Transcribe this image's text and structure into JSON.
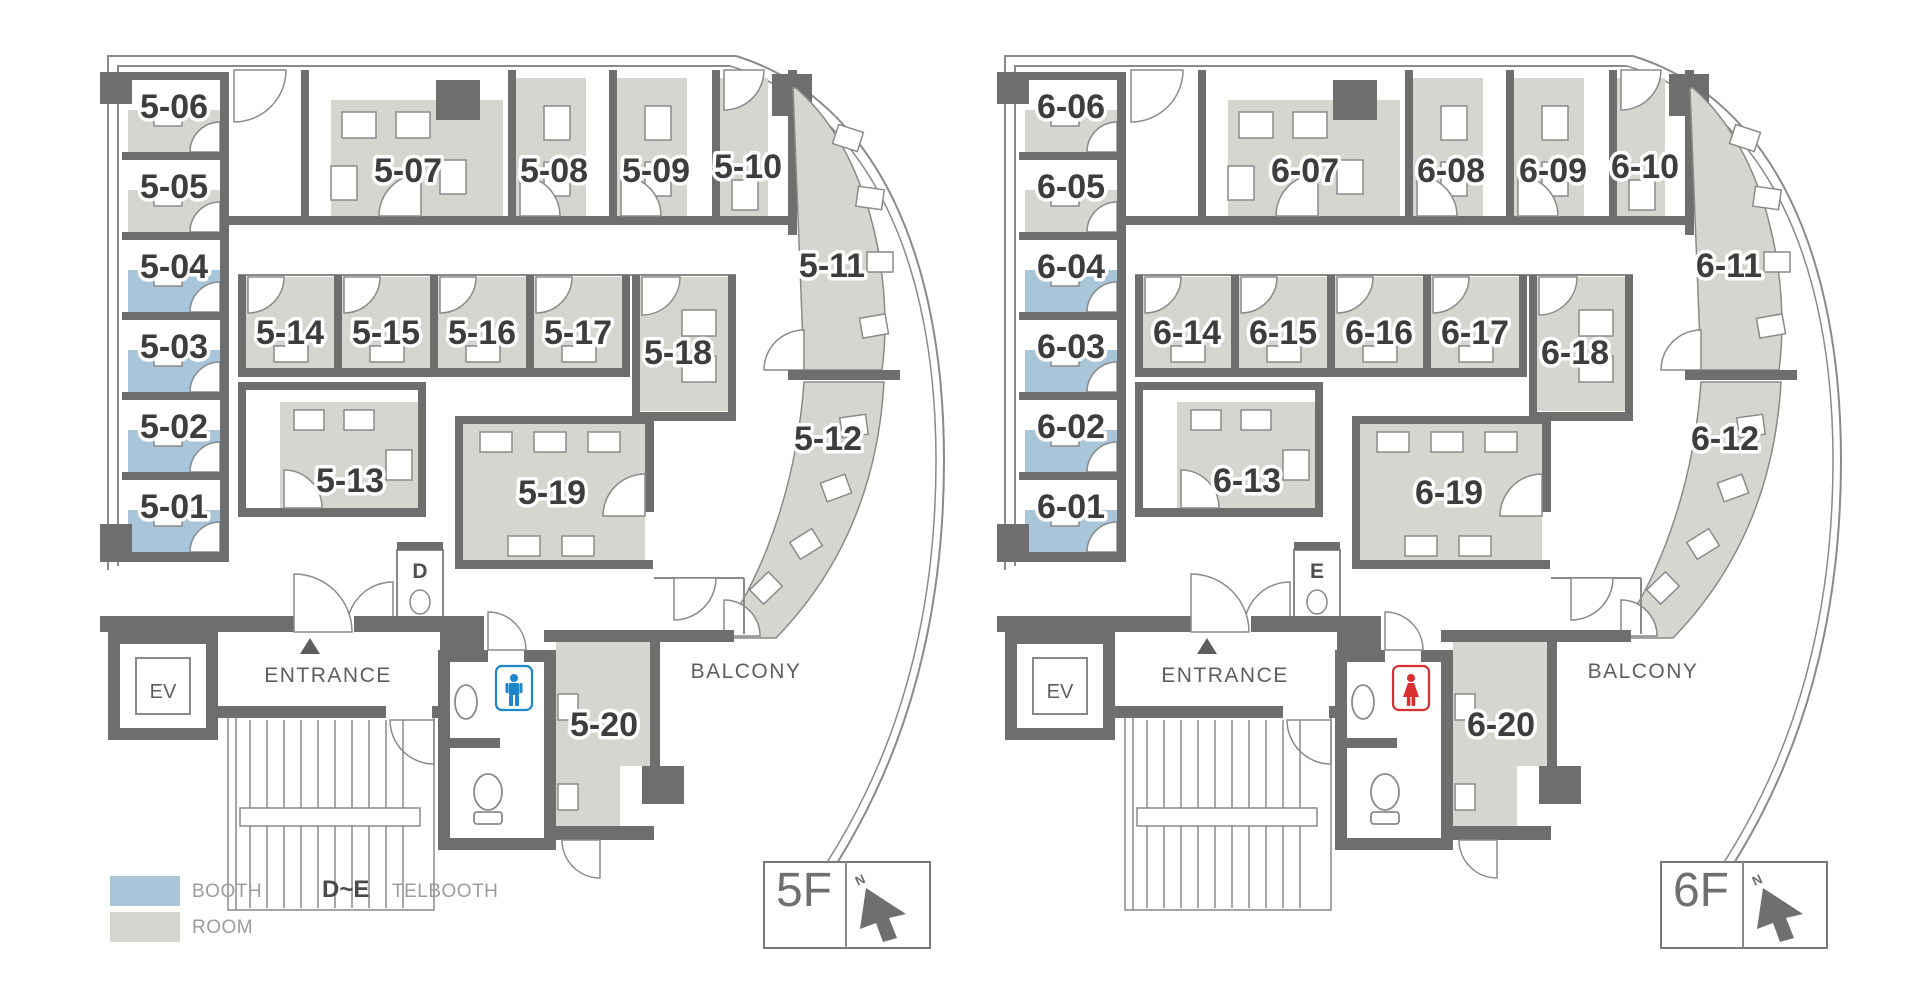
{
  "legend": {
    "booth_label": "BOOTH",
    "room_label": "ROOM",
    "telbooth_range": "D~E",
    "telbooth_label": "TELBOOTH"
  },
  "colors": {
    "booth": "#a9c5d9",
    "room": "#d6d6d1",
    "wall": "#6e6e6e",
    "line": "#8a8a8a",
    "label": "#3d3d3d",
    "text_muted": "#5e5e5e",
    "legend_text": "#9c9c9c",
    "male_icon": "#1d86c8",
    "female_icon": "#d92f2f",
    "marker_text": "#6f6f6f"
  },
  "floors": [
    {
      "name": "5F",
      "marker": {
        "floor": "5F",
        "north": "N"
      },
      "telbooth_letter": "D",
      "toilet_icon": "male",
      "labels": {
        "entrance": "ENTRANCE",
        "elevator": "EV",
        "balcony": "BALCONY"
      },
      "rooms": [
        {
          "id": "5-01",
          "type": "booth"
        },
        {
          "id": "5-02",
          "type": "booth"
        },
        {
          "id": "5-03",
          "type": "booth"
        },
        {
          "id": "5-04",
          "type": "booth"
        },
        {
          "id": "5-05",
          "type": "room"
        },
        {
          "id": "5-06",
          "type": "room"
        },
        {
          "id": "5-07",
          "type": "room"
        },
        {
          "id": "5-08",
          "type": "room"
        },
        {
          "id": "5-09",
          "type": "room"
        },
        {
          "id": "5-10",
          "type": "room"
        },
        {
          "id": "5-11",
          "type": "room"
        },
        {
          "id": "5-12",
          "type": "room"
        },
        {
          "id": "5-13",
          "type": "room"
        },
        {
          "id": "5-14",
          "type": "room"
        },
        {
          "id": "5-15",
          "type": "room"
        },
        {
          "id": "5-16",
          "type": "room"
        },
        {
          "id": "5-17",
          "type": "room"
        },
        {
          "id": "5-18",
          "type": "room"
        },
        {
          "id": "5-19",
          "type": "room"
        },
        {
          "id": "5-20",
          "type": "room"
        }
      ]
    },
    {
      "name": "6F",
      "marker": {
        "floor": "6F",
        "north": "N"
      },
      "telbooth_letter": "E",
      "toilet_icon": "female",
      "labels": {
        "entrance": "ENTRANCE",
        "elevator": "EV",
        "balcony": "BALCONY"
      },
      "rooms": [
        {
          "id": "6-01",
          "type": "booth"
        },
        {
          "id": "6-02",
          "type": "booth"
        },
        {
          "id": "6-03",
          "type": "booth"
        },
        {
          "id": "6-04",
          "type": "booth"
        },
        {
          "id": "6-05",
          "type": "room"
        },
        {
          "id": "6-06",
          "type": "room"
        },
        {
          "id": "6-07",
          "type": "room"
        },
        {
          "id": "6-08",
          "type": "room"
        },
        {
          "id": "6-09",
          "type": "room"
        },
        {
          "id": "6-10",
          "type": "room"
        },
        {
          "id": "6-11",
          "type": "room"
        },
        {
          "id": "6-12",
          "type": "room"
        },
        {
          "id": "6-13",
          "type": "room"
        },
        {
          "id": "6-14",
          "type": "room"
        },
        {
          "id": "6-15",
          "type": "room"
        },
        {
          "id": "6-16",
          "type": "room"
        },
        {
          "id": "6-17",
          "type": "room"
        },
        {
          "id": "6-18",
          "type": "room"
        },
        {
          "id": "6-19",
          "type": "room"
        },
        {
          "id": "6-20",
          "type": "room"
        }
      ]
    }
  ]
}
